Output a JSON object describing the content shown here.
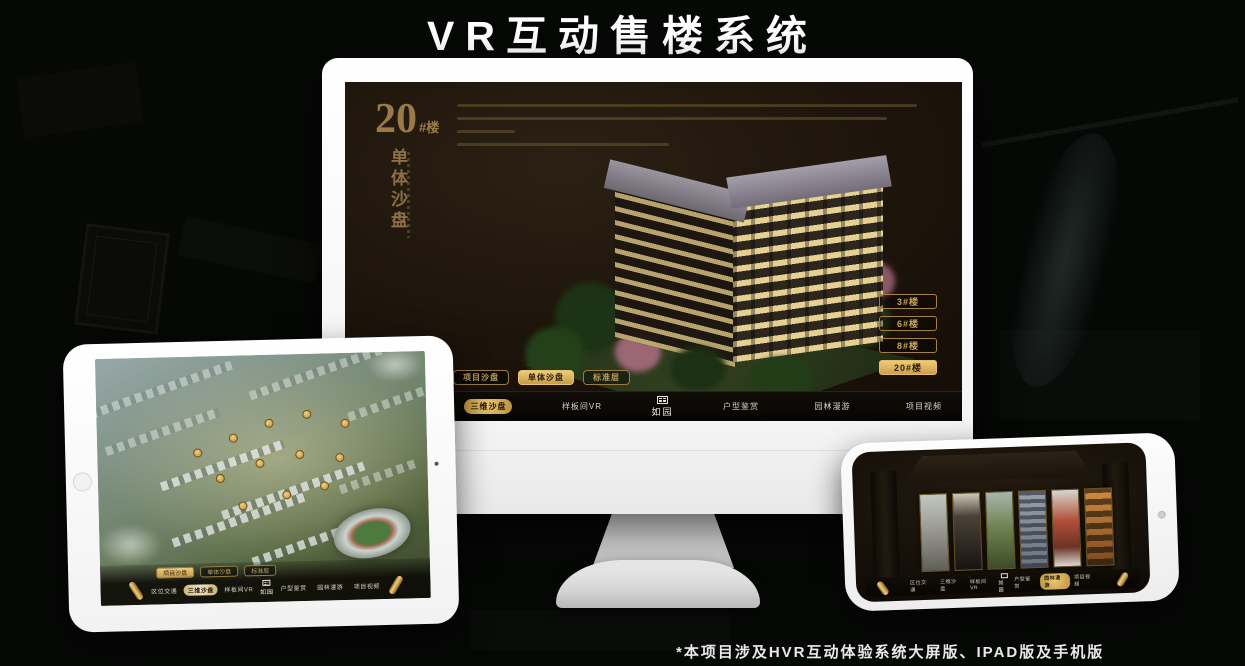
{
  "page": {
    "title": "VR互动售楼系统",
    "footnote": "*本项目涉及HVR互动体验系统大屏版、IPAD版及手机版"
  },
  "colors": {
    "accent_gold": "#c9a558",
    "gold_selected_bg": "#d9b367",
    "screen_background": "#1d140b",
    "page_background": "#060806"
  },
  "brand": {
    "logo_text": "如园"
  },
  "desktop_app": {
    "headline": {
      "number": "20",
      "suffix": "#楼",
      "subtitle": "单体沙盘"
    },
    "floor_buttons": [
      {
        "label": "3#楼",
        "selected": false
      },
      {
        "label": "6#楼",
        "selected": false
      },
      {
        "label": "8#楼",
        "selected": false
      },
      {
        "label": "20#楼",
        "selected": true
      }
    ],
    "mode_tabs": [
      {
        "label": "项目沙盘",
        "selected": false
      },
      {
        "label": "单体沙盘",
        "selected": true
      },
      {
        "label": "标准层",
        "selected": false
      }
    ],
    "nav": {
      "items": [
        {
          "label": "区位交通",
          "selected": false
        },
        {
          "label": "三维沙盘",
          "selected": true
        },
        {
          "label": "样板间VR",
          "selected": false
        },
        {
          "label": "户型鉴赏",
          "selected": false
        },
        {
          "label": "园林漫游",
          "selected": false
        },
        {
          "label": "项目视频",
          "selected": false
        }
      ]
    }
  },
  "tablet_app": {
    "mode_tabs": [
      {
        "label": "项目沙盘",
        "selected": true
      },
      {
        "label": "单体沙盘",
        "selected": false
      },
      {
        "label": "标准层",
        "selected": false
      }
    ],
    "nav": {
      "items": [
        {
          "label": "区位交通",
          "selected": false
        },
        {
          "label": "三维沙盘",
          "selected": true
        },
        {
          "label": "样板间VR",
          "selected": false
        },
        {
          "label": "户型鉴赏",
          "selected": false
        },
        {
          "label": "园林漫游",
          "selected": false
        },
        {
          "label": "项目视频",
          "selected": false
        }
      ]
    }
  },
  "phone_app": {
    "nav": {
      "items": [
        {
          "label": "区位交通",
          "selected": false
        },
        {
          "label": "三维沙盘",
          "selected": false
        },
        {
          "label": "样板间VR",
          "selected": false
        },
        {
          "label": "户型鉴赏",
          "selected": false
        },
        {
          "label": "园林漫游",
          "selected": true
        },
        {
          "label": "项目视频",
          "selected": false
        }
      ]
    }
  }
}
